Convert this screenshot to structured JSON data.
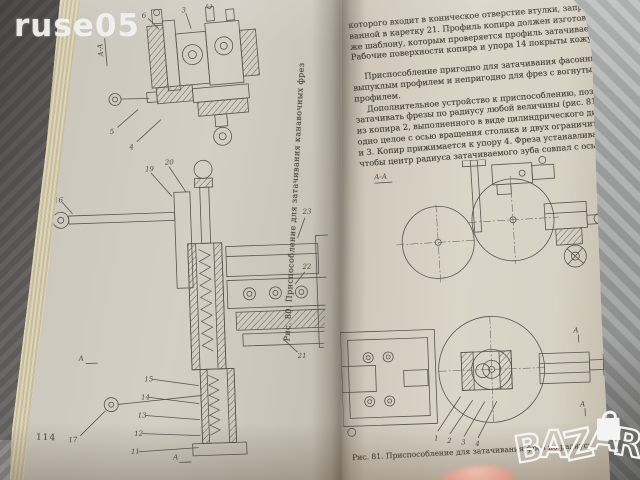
{
  "watermarks": {
    "seller": "ruse05",
    "marketplace_logo_letters": [
      "B",
      "A",
      "Z",
      "A",
      "R"
    ]
  },
  "book": {
    "left_page": {
      "page_number": "114",
      "section_label": "А-А",
      "figure_caption": "Рис. 80. Приспособление для затачивания канавочных фрез",
      "part_labels": {
        "top_figure": [
          "6",
          "5",
          "4",
          "3"
        ],
        "main_figure": [
          "16",
          "19",
          "20",
          "23",
          "22",
          "21",
          "15",
          "14",
          "13",
          "12",
          "11",
          "17"
        ]
      },
      "section_arrows": [
        "А",
        "А"
      ]
    },
    "right_page": {
      "p1": [
        "которого входит в коническое отверстие втулки, запрессо-",
        "ванной в каретку 21. Профиль копира должен изготовляться по",
        "же шаблону, которым проверяется профиль затачиваемой",
        "Рабочие поверхности копира и упора 14 покрыты кожу-"
      ],
      "p2": [
        "Приспособление пригодно для затачивания фасонных фрез с",
        "выпуклым профилем и непригодно для фрез с вогнутым",
        "профилем."
      ],
      "p3": [
        "Дополнительное устройство к приспособлению, позволяющее",
        "затачивать фрезы по радиусу любой величины (рис. 81), состоит",
        "из копира 2, выполненного в виде цилиндрического диска за",
        "одно целое с осью вращения столика и двух ограничителей 1",
        "и 3. Копир прижимается к упору 4. Фреза устанавливается так,",
        "чтобы центр радиуса затачиваемого зуба совпал с осью вра-"
      ],
      "figure": {
        "section_label": "А-А",
        "caption": "Рис. 81. Приспособление для затачивания фрез по радиусу",
        "part_labels": [
          "1",
          "2",
          "3",
          "4"
        ],
        "section_arrows": [
          "А",
          "А"
        ]
      }
    }
  },
  "colors": {
    "page_left": "#cbc6bb",
    "page_right": "#d7d1c4",
    "page_edge_strip": "#d3c9ab",
    "background_dark": "#6b6867",
    "background_light": "#a8aaa9",
    "ink": "#4b4841",
    "watermark": "#f4f4f4"
  }
}
